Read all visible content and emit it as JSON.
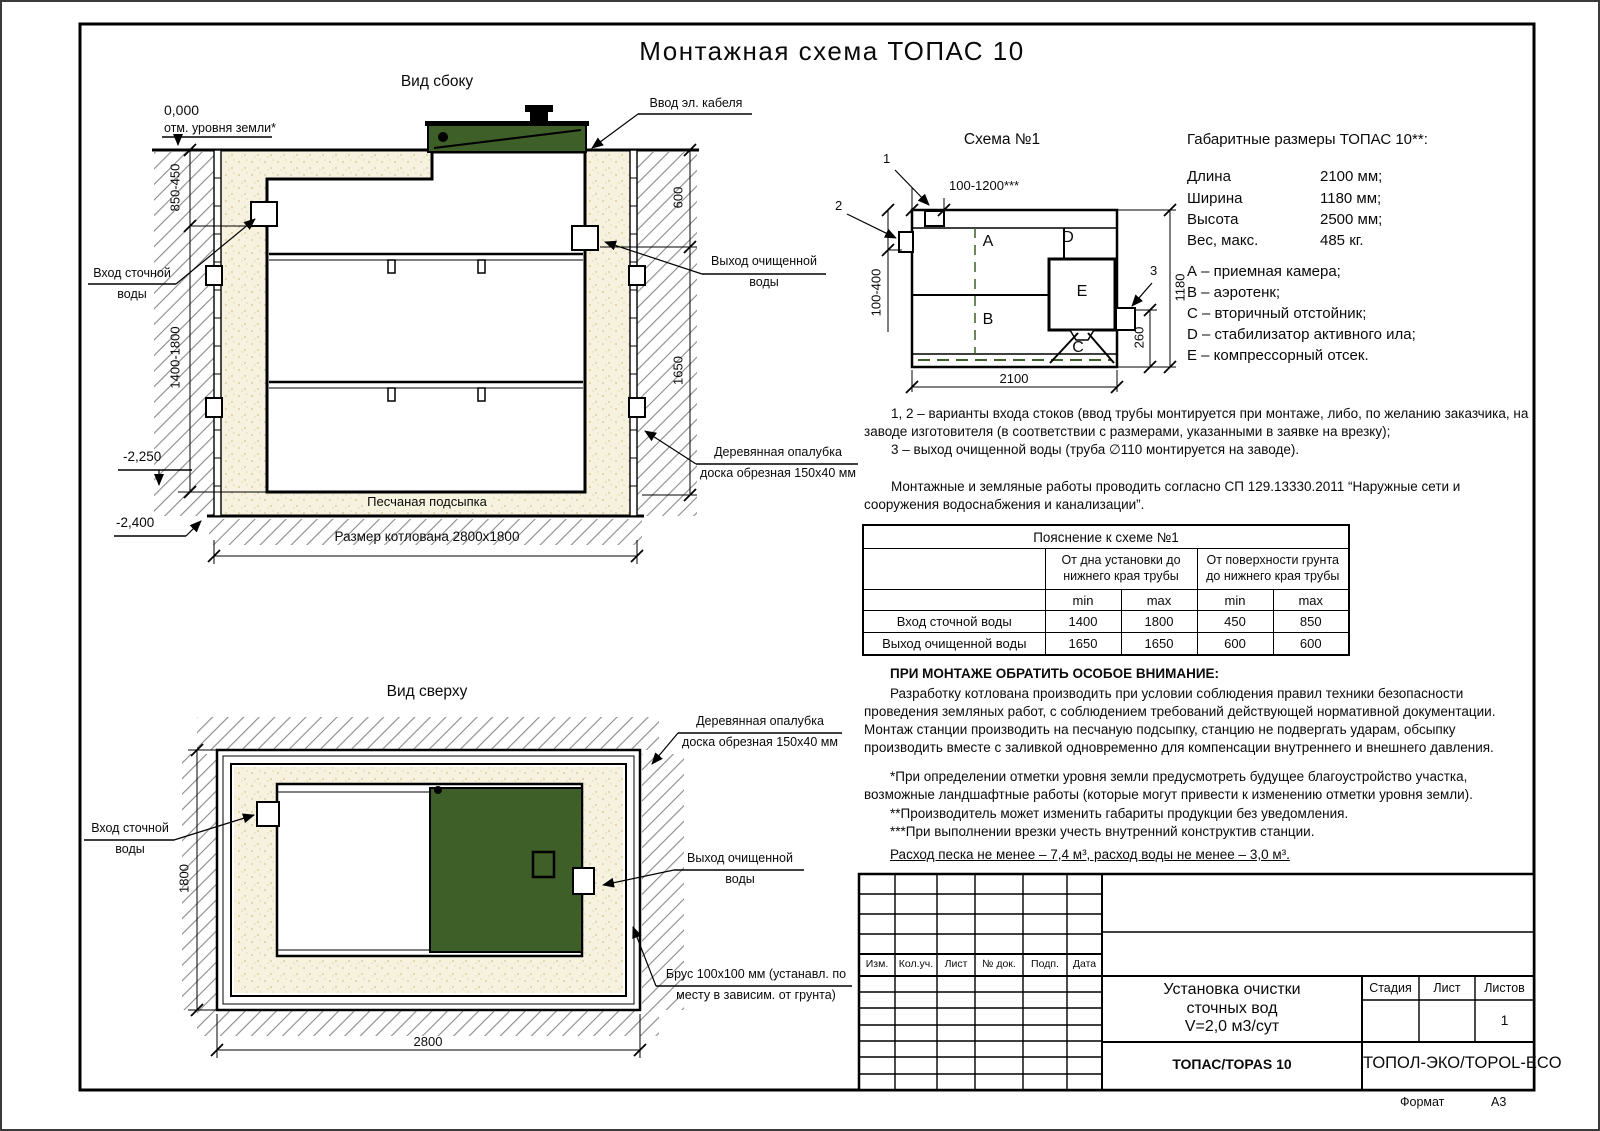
{
  "doc": {
    "title": "Монтажная схема ТОПАС 10",
    "format_label": "Формат",
    "format_value": "А3"
  },
  "side_view": {
    "title": "Вид сбоку",
    "zero_mark": "0,000",
    "zero_note": "отм. уровня земли*",
    "dim_inlet_depth": "850-450",
    "dim_body_depth": "1400-1800",
    "mark_minus2250": "-2,250",
    "mark_minus2400": "-2,400",
    "dim_600": "600",
    "dim_1650": "1650",
    "inlet_lines": [
      "Вход сточной",
      "воды"
    ],
    "outlet_lines": [
      "Выход очищенной",
      "воды"
    ],
    "cable_label": "Ввод эл. кабеля",
    "formwork_lines": [
      "Деревянная опалубка",
      "доска обрезная 150х40 мм"
    ],
    "sand_label": "Песчаная подсыпка",
    "pit_label": "Размер котлована 2800х1800"
  },
  "top_view": {
    "title": "Вид сверху",
    "dim_1800": "1800",
    "dim_2800": "2800",
    "inlet_lines": [
      "Вход сточной",
      "воды"
    ],
    "outlet_lines": [
      "Выход очищенной",
      "воды"
    ],
    "formwork_lines": [
      "Деревянная опалубка",
      "доска обрезная 150х40 мм"
    ],
    "beam_lines": [
      "Брус 100х100 мм (устанавл. по",
      "месту в зависим. от грунта)"
    ]
  },
  "schema": {
    "title": "Схема №1",
    "marker_1": "1",
    "marker_2": "2",
    "marker_3": "3",
    "dim_top": "100-1200***",
    "dim_left": "100-400",
    "dim_bottom": "2100",
    "dim_right": "1180",
    "dim_260": "260",
    "chamber_a": "А",
    "chamber_b": "В",
    "chamber_c": "С",
    "chamber_d": "D",
    "chamber_e": "E"
  },
  "specs": {
    "heading": "Габаритные размеры ТОПАС 10**:",
    "rows": [
      {
        "label": "Длина",
        "value": "2100 мм;"
      },
      {
        "label": "Ширина",
        "value": "1180 мм;"
      },
      {
        "label": "Высота",
        "value": "2500 мм;"
      },
      {
        "label": "Вес, макс.",
        "value": "485 кг."
      }
    ],
    "legend": [
      "А – приемная камера;",
      "В – аэротенк;",
      "С – вторичный отстойник;",
      "D – стабилизатор активного ила;",
      "E – компрессорный отсек."
    ]
  },
  "notes": {
    "variant_1": "1, 2 – варианты входа  стоков (ввод трубы монтируется при монтаже, либо, по желанию заказчика, на заводе изготовителя (в соответствии с размерами, указанными в заявке на врезку);",
    "variant_2": "3 – выход очищенной воды (труба ∅110 монтируется на заводе).",
    "sp_note": "Монтажные и земляные работы проводить согласно СП 129.13330.2011 “Наружные сети и сооружения водоснабжения и канализации”."
  },
  "table": {
    "title": "Пояснение к схеме №1",
    "group_headers": [
      "От дна установки до нижнего края трубы",
      "От поверхности грунта до нижнего края трубы"
    ],
    "sub_headers": [
      "min",
      "max",
      "min",
      "max"
    ],
    "rows": [
      {
        "name": "Вход сточной воды",
        "values": [
          "1400",
          "1800",
          "450",
          "850"
        ]
      },
      {
        "name": "Выход очищенной воды",
        "values": [
          "1650",
          "1650",
          "600",
          "600"
        ]
      }
    ]
  },
  "attention": {
    "heading": "ПРИ МОНТАЖЕ ОБРАТИТЬ ОСОБОЕ ВНИМАНИЕ:",
    "body": "Разработку котлована производить при условии соблюдения правил техники безопасности проведения земляных работ, с соблюдением требований действующей нормативной документации. Монтаж станции производить на песчаную подсыпку, станцию не подвергать ударам, обсыпку производить вместе с заливкой одновременно для компенсации внутреннего и внешнего давления.",
    "footnote_1": "*При определении отметки уровня земли предусмотреть будущее благоустройство участка, возможные ландшафтные работы (которые могут привести к изменению отметки уровня земли).",
    "footnote_2": "**Производитель может изменить габариты продукции без уведомления.",
    "footnote_3": "***При выполнении врезки учесть внутренний конструктив станции.",
    "consumption": "Расход песка не менее – 7,4 м³, расход воды не менее – 3,0 м³."
  },
  "title_block": {
    "stamp_headers": [
      "Изм.",
      "Кол.уч.",
      "Лист",
      "№ док.",
      "Подп.",
      "Дата"
    ],
    "doc_title_lines": [
      "Установка очистки",
      "сточных вод",
      "V=2,0 м3/сут"
    ],
    "stage_label": "Стадия",
    "sheet_label": "Лист",
    "sheets_label": "Листов",
    "sheets_value": "1",
    "product": "ТОПАС/TOPAS 10",
    "company": "ТОПОЛ-ЭКО/TOPOL-ECO"
  },
  "colors": {
    "lid_green": "#3f5f28",
    "sand": "#f6f2df"
  }
}
